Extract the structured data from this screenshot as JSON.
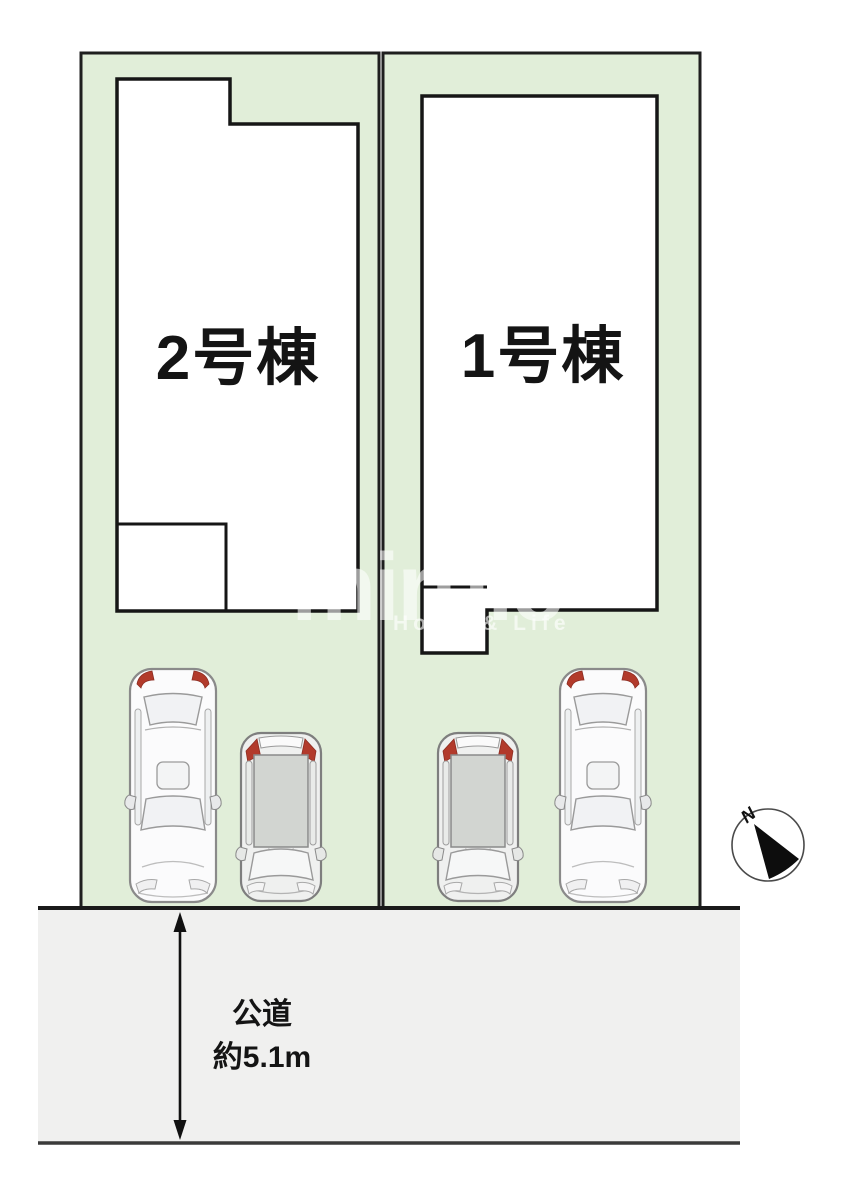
{
  "diagram": {
    "type": "real-estate-site-plan",
    "building_left": {
      "label": "2号棟"
    },
    "building_right": {
      "label": "1号棟"
    },
    "road": {
      "name": "公道",
      "width_note": "約5.1m"
    },
    "compass": {
      "north_label": "N"
    },
    "watermark": {
      "logo": "miruie",
      "tagline": "Home & Life"
    },
    "icons": {
      "cars": [
        "sedan-topview",
        "compact-car-topview",
        "compact-car-topview",
        "sedan-topview"
      ],
      "compass": "north-compass-icon",
      "dimension": "double-headed-arrow-icon"
    },
    "colors": {
      "plot_fill": "#e1eed9",
      "road_fill": "#f0f0ef",
      "outline": "#1f1f1f",
      "taillight_red": "#b23a2b",
      "car_roof_gray": "#d2d5d1",
      "watermark_white": "rgba(255,255,255,0.6)"
    }
  }
}
